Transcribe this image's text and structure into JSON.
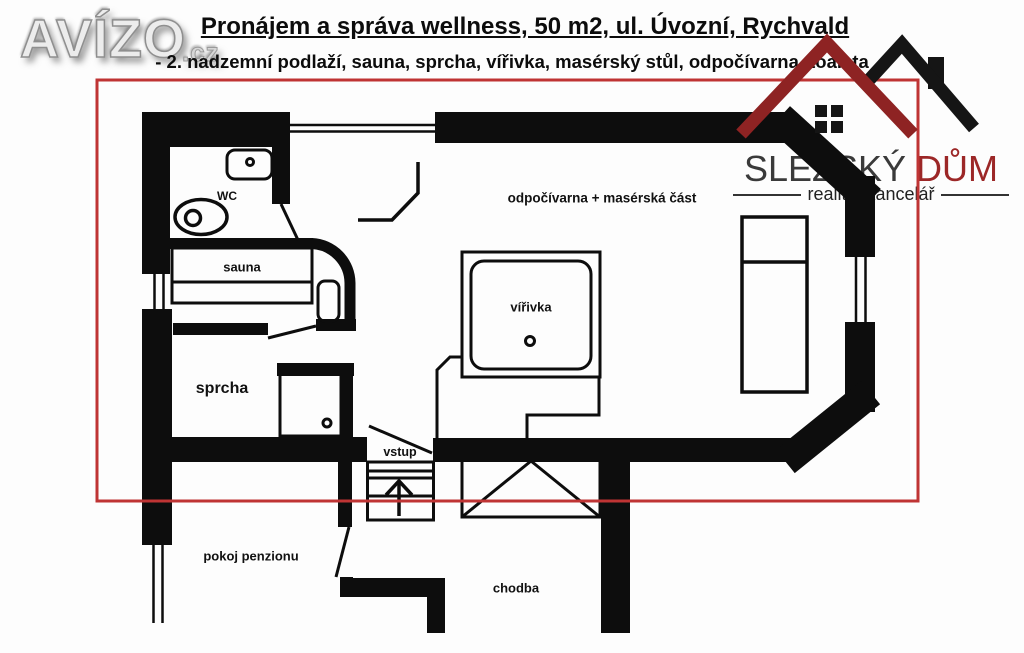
{
  "branding": {
    "avizo": {
      "wordmark": "AVÍZO",
      "tld": ".cz"
    },
    "slezsky_dum": {
      "name_part1": "SLEZSKÝ",
      "name_part2": "DŮM",
      "tagline": "realitní kancelář",
      "roof_red": "#8e2323",
      "roof_black": "#151515",
      "name_red": "#9c2727",
      "name_dark": "#3a3a3a"
    }
  },
  "header": {
    "title": "Pronájem a správa wellness, 50 m2, ul. Úvozní, Rychvald",
    "subtitle": "- 2. nadzemní podlaží, sauna, sprcha, vířivka, masérský stůl, odpočívarna, toaleta"
  },
  "floorplan": {
    "highlight_color": "#bf3434",
    "wall_color": "#0d0d0d",
    "rooms": [
      {
        "id": "wc",
        "label": "WC"
      },
      {
        "id": "sauna",
        "label": "sauna"
      },
      {
        "id": "sprcha",
        "label": "sprcha"
      },
      {
        "id": "virivka",
        "label": "vířivka"
      },
      {
        "id": "odpocivarna",
        "label": "odpočívarna + masérská část"
      },
      {
        "id": "vstup",
        "label": "vstup"
      },
      {
        "id": "pokoj_penzionu",
        "label": "pokoj penzionu"
      },
      {
        "id": "chodba",
        "label": "chodba"
      }
    ]
  }
}
